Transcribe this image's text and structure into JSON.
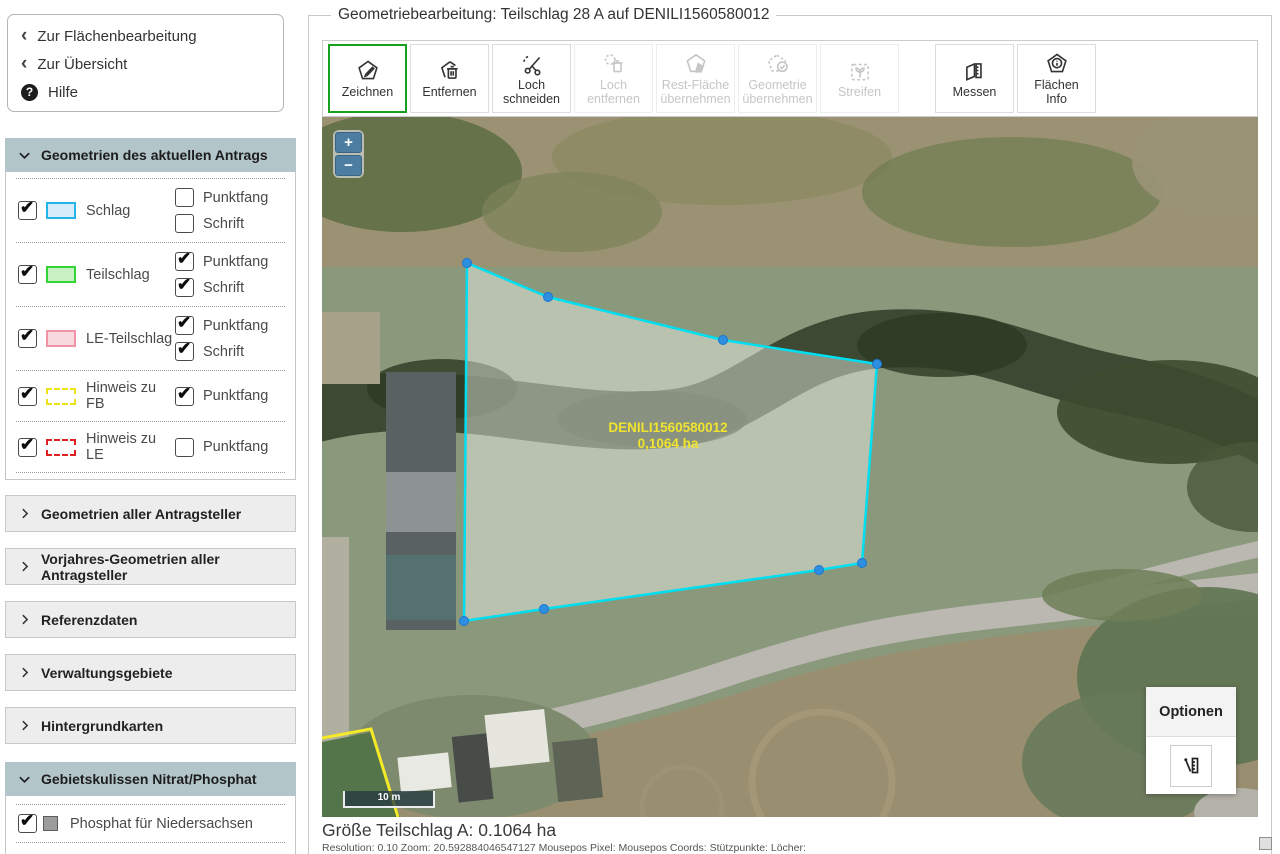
{
  "header": {
    "title": "Geometriebearbeitung: Teilschlag 28 A auf DENILI1560580012"
  },
  "nav": {
    "back_to_area_editing": "Zur Flächenbearbeitung",
    "back_to_overview": "Zur Übersicht",
    "help": "Hilfe"
  },
  "sidebar": {
    "panel_current": {
      "title": "Geometrien des aktuellen Antrags",
      "rows": [
        {
          "label": "Schlag",
          "checked": true,
          "options": [
            {
              "label": "Punktfang",
              "checked": false
            },
            {
              "label": "Schrift",
              "checked": false
            }
          ]
        },
        {
          "label": "Teilschlag",
          "checked": true,
          "options": [
            {
              "label": "Punktfang",
              "checked": true
            },
            {
              "label": "Schrift",
              "checked": true
            }
          ]
        },
        {
          "label": "LE-Teilschlag",
          "checked": true,
          "options": [
            {
              "label": "Punktfang",
              "checked": true
            },
            {
              "label": "Schrift",
              "checked": true
            }
          ]
        },
        {
          "label": "Hinweis zu FB",
          "checked": true,
          "options": [
            {
              "label": "Punktfang",
              "checked": true
            }
          ]
        },
        {
          "label": "Hinweis zu LE",
          "checked": true,
          "options": [
            {
              "label": "Punktfang",
              "checked": false
            }
          ]
        }
      ]
    },
    "collapsed_panels": [
      {
        "title": "Geometrien aller Antragsteller"
      },
      {
        "title": "Vorjahres-Geometrien aller Antragsteller"
      },
      {
        "title": "Referenzdaten"
      },
      {
        "title": "Verwaltungsgebiete"
      },
      {
        "title": "Hintergrundkarten"
      }
    ],
    "panel_nitrat": {
      "title": "Gebietskulissen Nitrat/Phosphat",
      "row": {
        "label": "Phosphat für Niedersachsen",
        "checked": true
      }
    }
  },
  "toolbar": {
    "buttons": [
      {
        "label": "Zeichnen",
        "state": "active"
      },
      {
        "label": "Entfernen",
        "state": "enabled"
      },
      {
        "label": "Loch\nschneiden",
        "state": "enabled"
      },
      {
        "label": "Loch\nentfernen",
        "state": "disabled"
      },
      {
        "label": "Rest-Fläche\nübernehmen",
        "state": "disabled"
      },
      {
        "label": "Geometrie\nübernehmen",
        "state": "disabled"
      },
      {
        "label": "Streifen",
        "state": "disabled"
      },
      {
        "label": "Messen",
        "state": "enabled"
      },
      {
        "label": "Flächen\nInfo",
        "state": "enabled"
      }
    ]
  },
  "map": {
    "zoom_in": "+",
    "zoom_out": "−",
    "scale_label": "10 m",
    "parcel_label_line1": "DENILI1560580012",
    "parcel_label_line2": "0,1064 ha",
    "options_panel": {
      "title": "Optionen"
    }
  },
  "statusbar": {
    "size_label": "Größe Teilschlag A: 0.1064 ha",
    "info_line": "Resolution: 0.10 Zoom: 20.592884046547127 Mousepos Pixel: Mousepos Coords: Stützpunkte: Löcher:"
  },
  "colors": {
    "active_tool_border": "#17a01d",
    "panel_header_bg": "#b2c5c9",
    "parcel_stroke": "#00dff2",
    "vertex_fill": "#2e8fe0",
    "parcel_label_text": "#f0e42e",
    "hint_fb_line": "#f5ea28",
    "schlag_swatch_fill": "#d6ecf8",
    "schlag_swatch_border": "#25b4e8",
    "teilschlag_swatch_fill": "#c9f2c4",
    "teilschlag_swatch_border": "#35d435",
    "le_teilschlag_swatch_fill": "#f7d9de",
    "le_teilschlag_swatch_border": "#ef93a5",
    "hinweis_fb_swatch_border": "#ece217",
    "hinweis_le_swatch_border": "#e02020",
    "phosphat_swatch": "#9c9c9c",
    "zoom_button_bg": "#4d7da0"
  }
}
